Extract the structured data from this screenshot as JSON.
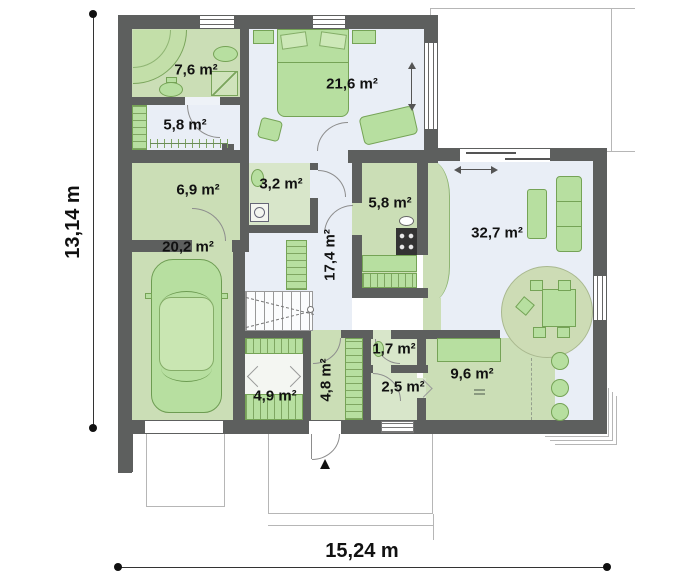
{
  "plan": {
    "type": "floor-plan",
    "dimensions": {
      "width_label": "15,24 m",
      "height_label": "13,14 m"
    },
    "rooms": [
      {
        "id": "bathroom",
        "area_label": "7,6 m²"
      },
      {
        "id": "upper-hallway",
        "area_label": "5,8 m²"
      },
      {
        "id": "bedroom",
        "area_label": "21,6 m²"
      },
      {
        "id": "utility-room",
        "area_label": "6,9 m²"
      },
      {
        "id": "toilet",
        "area_label": "3,2 m²"
      },
      {
        "id": "garage",
        "area_label": "20,2 m²"
      },
      {
        "id": "hall",
        "area_label": "17,4 m²"
      },
      {
        "id": "kitchen",
        "area_label": "5,8 m²"
      },
      {
        "id": "living-room",
        "area_label": "32,7 m²"
      },
      {
        "id": "wardrobe",
        "area_label": "4,9 m²"
      },
      {
        "id": "entry-hall",
        "area_label": "4,8 m²"
      },
      {
        "id": "small-wc",
        "area_label": "1,7 m²"
      },
      {
        "id": "vestibule",
        "area_label": "2,5 m²"
      },
      {
        "id": "study",
        "area_label": "9,6 m²"
      }
    ],
    "icons": {
      "entrance_marker": "▲"
    },
    "colors": {
      "wall": "#5d5f5e",
      "floor_green": "#cbdeb6",
      "floor_pale_green": "#d8e6ca",
      "floor_blue": "#e9eef6",
      "furniture_green": "#b7dfa0",
      "furniture_border": "#75a356",
      "label_text": "#111111"
    }
  }
}
